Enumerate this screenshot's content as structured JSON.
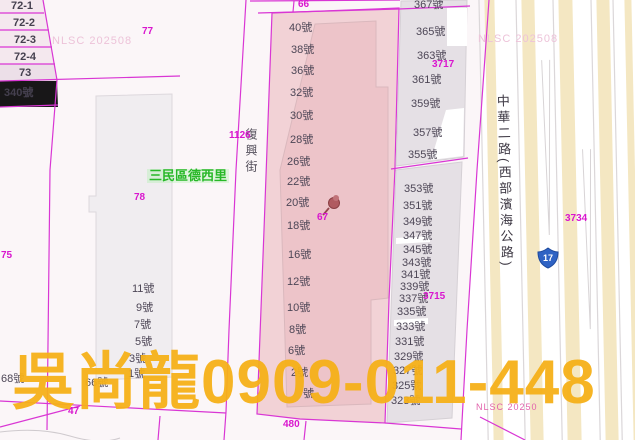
{
  "map": {
    "district_label": "三民區德西里",
    "street_name": "復興街",
    "road_name": "中華二路(西部濱海公路)",
    "route_shield": "17",
    "watermark": "吳尚龍0909-011-448",
    "nlsc_top_left": "NLSC 202508",
    "nlsc_top_right": "NLSC 202508",
    "nlsc_bottom_right": "NLSC 20250"
  },
  "colors": {
    "boundary_magenta": "#d936d4",
    "selected_parcel_pink": "#f2d2d6",
    "selected_parcel_inner": "#edc4c9",
    "building_gray": "#e5e0e5",
    "watermark_orange": "#f6b119",
    "route_shield_blue": "#2f63c4",
    "district_green": "#28b828",
    "road_stripe_cream": "#f4e7c2"
  },
  "label_layers": [
    {
      "name": "left-parcel-row",
      "style": "hn hnb",
      "items": [
        {
          "t": "72-1",
          "x": 11,
          "y": 1
        },
        {
          "t": "72-2",
          "x": 13,
          "y": 18
        },
        {
          "t": "72-3",
          "x": 14,
          "y": 35
        },
        {
          "t": "72-4",
          "x": 14,
          "y": 52
        },
        {
          "t": "73",
          "x": 19,
          "y": 68
        },
        {
          "t": "340號",
          "x": 4,
          "y": 88
        }
      ]
    },
    {
      "name": "left-building-number",
      "style": "hn",
      "items": [
        {
          "t": "11號",
          "x": 132,
          "y": 284
        },
        {
          "t": "9號",
          "x": 136,
          "y": 303
        },
        {
          "t": "7號",
          "x": 134,
          "y": 320
        },
        {
          "t": "5號",
          "x": 135,
          "y": 337
        },
        {
          "t": "3號",
          "x": 129,
          "y": 354
        },
        {
          "t": "1號",
          "x": 128,
          "y": 369
        }
      ]
    },
    {
      "name": "bottom-left-number",
      "style": "hn",
      "items": [
        {
          "t": "68號",
          "x": 1,
          "y": 374
        },
        {
          "t": "66號",
          "x": 85,
          "y": 378
        }
      ]
    },
    {
      "name": "center-building-number",
      "style": "hn",
      "items": [
        {
          "t": "40號",
          "x": 289,
          "y": 23
        },
        {
          "t": "38號",
          "x": 291,
          "y": 45
        },
        {
          "t": "36號",
          "x": 291,
          "y": 66
        },
        {
          "t": "32號",
          "x": 290,
          "y": 88
        },
        {
          "t": "30號",
          "x": 290,
          "y": 111
        },
        {
          "t": "28號",
          "x": 290,
          "y": 135
        },
        {
          "t": "26號",
          "x": 287,
          "y": 157
        },
        {
          "t": "22號",
          "x": 287,
          "y": 177
        },
        {
          "t": "20號",
          "x": 286,
          "y": 198
        },
        {
          "t": "18號",
          "x": 287,
          "y": 221
        },
        {
          "t": "16號",
          "x": 288,
          "y": 250
        },
        {
          "t": "12號",
          "x": 287,
          "y": 277
        },
        {
          "t": "10號",
          "x": 287,
          "y": 303
        },
        {
          "t": "8號",
          "x": 289,
          "y": 325
        },
        {
          "t": "6號",
          "x": 288,
          "y": 346
        },
        {
          "t": "2號",
          "x": 291,
          "y": 368
        },
        {
          "t": "號",
          "x": 303,
          "y": 389
        }
      ]
    },
    {
      "name": "right-building-number",
      "style": "hn",
      "items": [
        {
          "t": "367號",
          "x": 414,
          "y": 0
        },
        {
          "t": "365號",
          "x": 416,
          "y": 27
        },
        {
          "t": "363號",
          "x": 417,
          "y": 51
        },
        {
          "t": "361號",
          "x": 412,
          "y": 75
        },
        {
          "t": "359號",
          "x": 411,
          "y": 99
        },
        {
          "t": "357號",
          "x": 413,
          "y": 128
        },
        {
          "t": "355號",
          "x": 408,
          "y": 150
        },
        {
          "t": "353號",
          "x": 404,
          "y": 184
        },
        {
          "t": "351號",
          "x": 403,
          "y": 201
        },
        {
          "t": "349號",
          "x": 403,
          "y": 217
        },
        {
          "t": "347號",
          "x": 403,
          "y": 231
        },
        {
          "t": "345號",
          "x": 403,
          "y": 245
        },
        {
          "t": "343號",
          "x": 402,
          "y": 258
        },
        {
          "t": "341號",
          "x": 401,
          "y": 270
        },
        {
          "t": "339號",
          "x": 400,
          "y": 282
        },
        {
          "t": "337號",
          "x": 399,
          "y": 294
        },
        {
          "t": "335號",
          "x": 397,
          "y": 307
        },
        {
          "t": "333號",
          "x": 396,
          "y": 322
        },
        {
          "t": "331號",
          "x": 395,
          "y": 337
        },
        {
          "t": "329號",
          "x": 394,
          "y": 352
        },
        {
          "t": "327號",
          "x": 393,
          "y": 366
        },
        {
          "t": "325號",
          "x": 392,
          "y": 381
        },
        {
          "t": "323號",
          "x": 391,
          "y": 396
        }
      ]
    },
    {
      "name": "parcel-number",
      "style": "pn",
      "items": [
        {
          "t": "66",
          "x": 298,
          "y": 0
        },
        {
          "t": "77",
          "x": 142,
          "y": 27
        },
        {
          "t": "78",
          "x": 134,
          "y": 193
        },
        {
          "t": "75",
          "x": 1,
          "y": 251
        },
        {
          "t": "67",
          "x": 317,
          "y": 213
        },
        {
          "t": "1126",
          "x": 229,
          "y": 131
        },
        {
          "t": "3717",
          "x": 432,
          "y": 60
        },
        {
          "t": "3715",
          "x": 423,
          "y": 292
        },
        {
          "t": "3734",
          "x": 565,
          "y": 214
        },
        {
          "t": "480",
          "x": 283,
          "y": 420
        },
        {
          "t": "47",
          "x": 68,
          "y": 407
        }
      ]
    }
  ]
}
